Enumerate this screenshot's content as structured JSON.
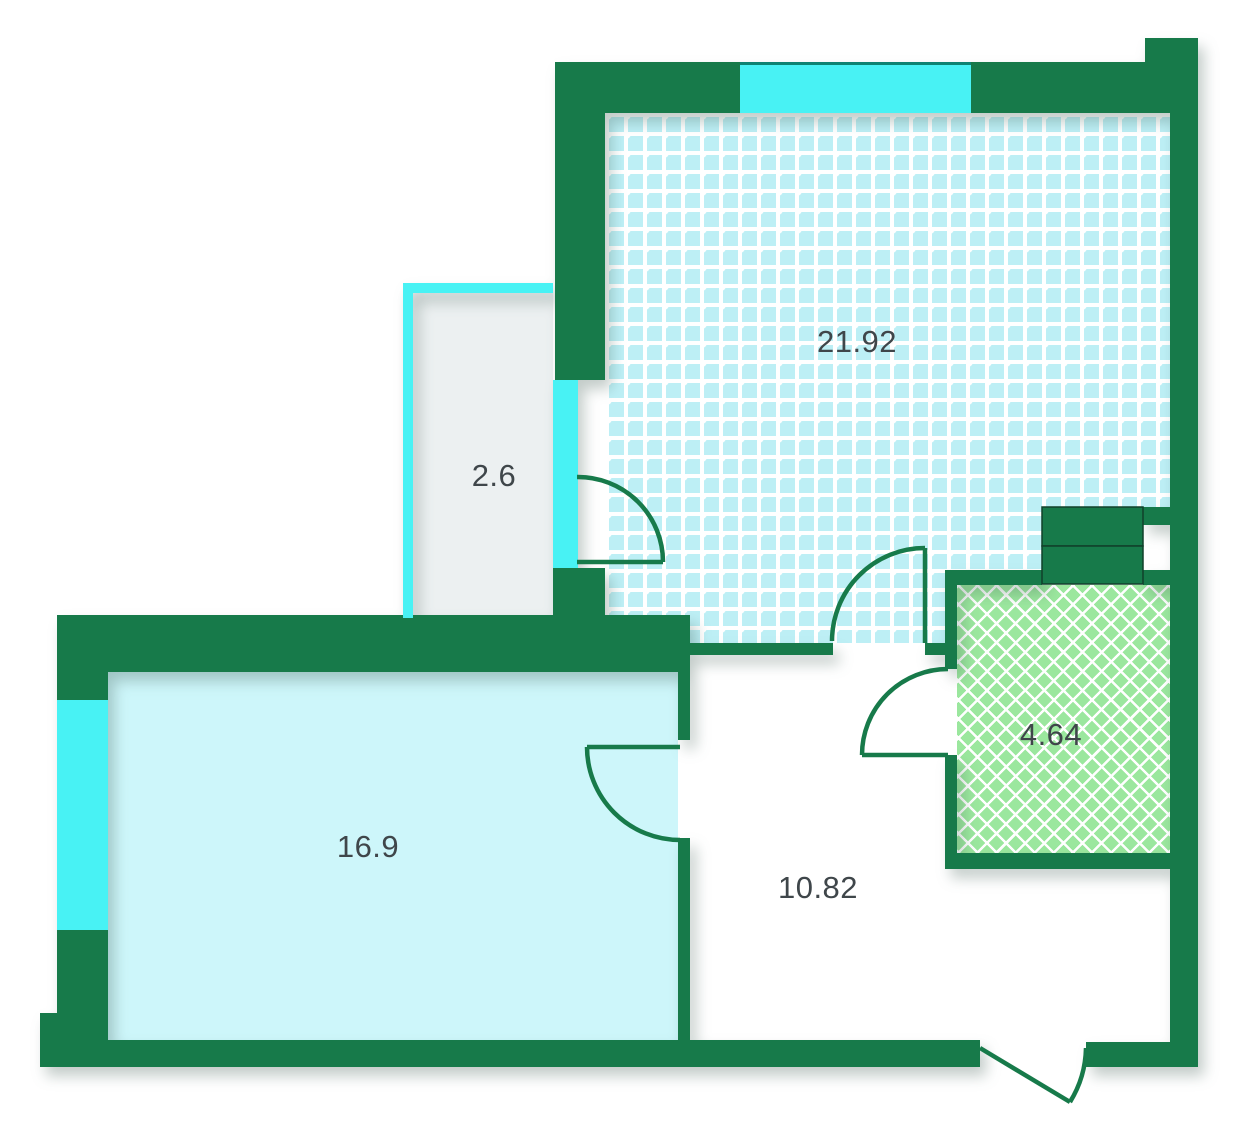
{
  "plan": {
    "title": "apartment-floor-plan",
    "rooms": [
      {
        "id": "living-room",
        "area": "21.92",
        "fill_pattern": "cyan-dot-grid"
      },
      {
        "id": "balcony",
        "area": "2.6",
        "fill_pattern": "plain-gray"
      },
      {
        "id": "bedroom",
        "area": "16.9",
        "fill_pattern": "plain-cyan"
      },
      {
        "id": "hallway",
        "area": "10.82",
        "fill_pattern": "plain-white"
      },
      {
        "id": "bathroom",
        "area": "4.64",
        "fill_pattern": "green-diamond-tiles"
      }
    ],
    "colors": {
      "wall": "#177A4A",
      "window": "#48F2F4",
      "living_dots": "#BDEFF5",
      "bedroom_fill": "#CDF6FA",
      "bathroom_fill": "#9BE79E",
      "balcony_fill": "#ECF0F1",
      "label_text": "#3F464A"
    }
  }
}
